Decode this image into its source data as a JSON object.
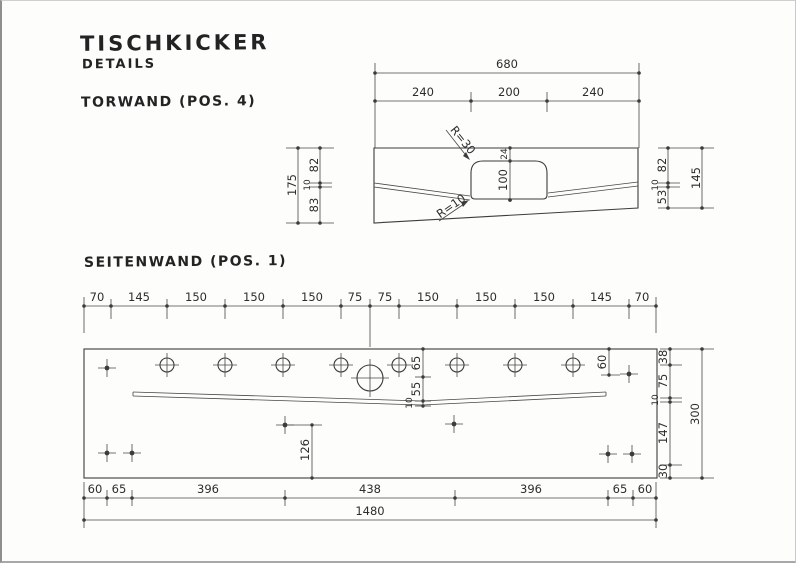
{
  "page": {
    "title": "TISCHKICKER",
    "subtitle": "DETAILS",
    "section_torwand": "TORWAND (POS. 4)",
    "section_seitenwand": "SEITENWAND (POS. 1)"
  },
  "colors": {
    "line": "#3c3c3c",
    "panel_fill": "#f5f3e3",
    "opening_fill": "#fbfaf2",
    "paper": "#fdfdfb"
  },
  "torwand": {
    "total_width": "680",
    "width_segments": [
      "240",
      "200",
      "240"
    ],
    "left_total": "175",
    "left_segments": [
      "82",
      "10",
      "83"
    ],
    "right_segments": [
      "82",
      "10",
      "53"
    ],
    "right_total": "145",
    "opening_top_offset": "24",
    "opening_height": "100",
    "radius_top_label": "R=30",
    "radius_bottom_label": "R=10"
  },
  "seitenwand": {
    "top_segments": [
      "70",
      "145",
      "150",
      "150",
      "150",
      "75",
      "75",
      "150",
      "150",
      "150",
      "145",
      "70"
    ],
    "center_segments": [
      "65",
      "55",
      "10"
    ],
    "hole_depth_right": "60",
    "hole_height_bottom": "126",
    "right_segments": [
      "38",
      "75",
      "10",
      "147",
      "30"
    ],
    "right_total": "300",
    "bottom_segments": [
      "60",
      "65",
      "396",
      "438",
      "396",
      "65",
      "60"
    ],
    "total_length": "1480"
  }
}
